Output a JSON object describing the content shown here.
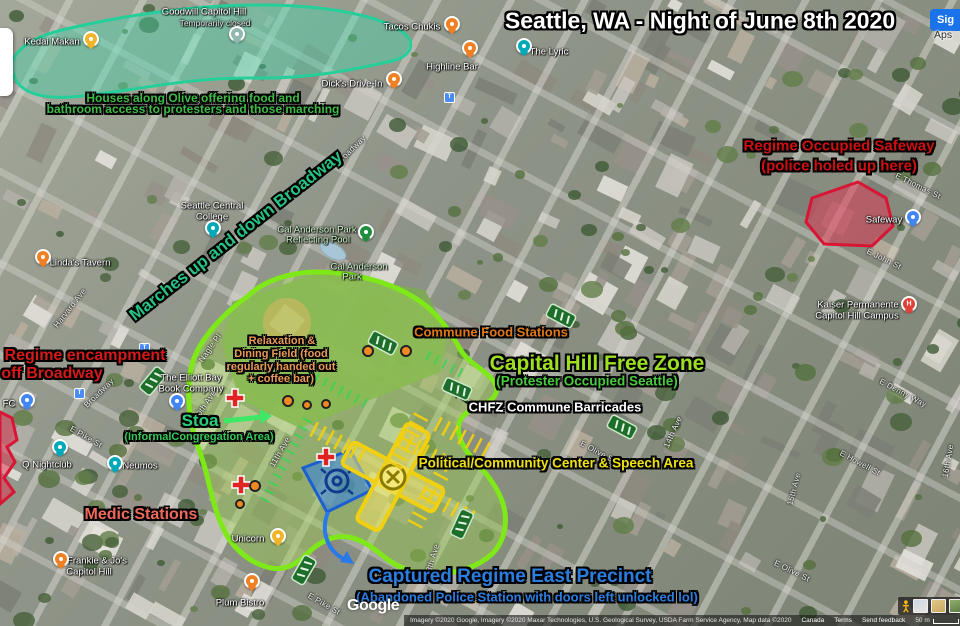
{
  "title": "Seattle, WA - Night of June 8th 2020",
  "colors": {
    "freezone": "#7ee818",
    "freezone_fill": "#9ed44e",
    "olive_houses": "#25cf9a",
    "red_zone": "#d81535",
    "red_zone_fill": "#e23050",
    "precinct": "#1b5fd0",
    "precinct_fill": "#2e7fe8",
    "intersection": "#f0d010",
    "barricade": "#1c6e2a",
    "medic_cross": "#e02424",
    "food_blob": "#f08824",
    "pins": {
      "food": "#ef8024",
      "bar": "#00a9b7",
      "shop": "#4285f4",
      "gold": "#f0b429",
      "park": "#1e8e3e",
      "hospital": "#e04238",
      "muted": "#90b8b0"
    }
  },
  "annotations": [
    {
      "name": "main-title",
      "text": "Seattle, WA - Night of June 8th 2020",
      "x": 700,
      "y": 21,
      "size": 23,
      "color": "#ffffff",
      "rot": 0
    },
    {
      "name": "houses-olive-line1",
      "text": "Houses along Olive offering food and",
      "x": 193,
      "y": 98,
      "size": 12,
      "color": "#3dbb45",
      "rot": 0
    },
    {
      "name": "houses-olive-line2",
      "text": "bathroom access to protesters and those marching",
      "x": 193,
      "y": 109,
      "size": 12,
      "color": "#3dbb45",
      "rot": 0
    },
    {
      "name": "marches-broadway",
      "text": "Marches up and down Broadway",
      "x": 236,
      "y": 236,
      "size": 17,
      "color": "#27c285",
      "rot": -38
    },
    {
      "name": "safeway-line1",
      "text": "Regime Occupied Safeway",
      "x": 839,
      "y": 146,
      "size": 15,
      "color": "#d01010",
      "rot": 0
    },
    {
      "name": "safeway-line2",
      "text": "(police holed up here)",
      "x": 839,
      "y": 166,
      "size": 15,
      "color": "#d01010",
      "rot": 0
    },
    {
      "name": "encampment-line1",
      "text": "Regime encampment",
      "x": 85,
      "y": 356,
      "size": 16,
      "color": "#d41a1a",
      "rot": 0
    },
    {
      "name": "encampment-line2",
      "text": "off Broadway",
      "x": 52,
      "y": 374,
      "size": 16,
      "color": "#d41a1a",
      "rot": 0
    },
    {
      "name": "commune-food",
      "text": "Commune Food Stations",
      "x": 491,
      "y": 332,
      "size": 13,
      "color": "#e07818",
      "rot": 0
    },
    {
      "name": "freezone-title",
      "text": "Capital Hill Free Zone",
      "x": 597,
      "y": 364,
      "size": 21,
      "color": "#9ee020",
      "rot": 0
    },
    {
      "name": "freezone-sub",
      "text": "(Protester Occupied Seattle)",
      "x": 587,
      "y": 381,
      "size": 13.5,
      "color": "#48c93e",
      "rot": 0
    },
    {
      "name": "chfz-barricades",
      "text": "CHFZ Commune Barricades",
      "x": 555,
      "y": 407,
      "size": 13,
      "color": "#ffffff",
      "rot": 0
    },
    {
      "name": "political-center",
      "text": "Political/Community Center & Speech Area",
      "x": 556,
      "y": 463,
      "size": 13.5,
      "color": "#f0e212",
      "rot": 0
    },
    {
      "name": "relax-line1",
      "text": "Relaxation &",
      "x": 282,
      "y": 341,
      "size": 11,
      "color": "#e89858",
      "rot": 0
    },
    {
      "name": "relax-line2",
      "text": "Dining Field (food",
      "x": 281,
      "y": 354,
      "size": 11,
      "color": "#e89858",
      "rot": 0
    },
    {
      "name": "relax-line3",
      "text": "regularly handed out",
      "x": 281,
      "y": 367,
      "size": 11,
      "color": "#e89858",
      "rot": 0
    },
    {
      "name": "relax-line4",
      "text": "+ coffee bar)",
      "x": 281,
      "y": 379,
      "size": 11,
      "color": "#e89858",
      "rot": 0
    },
    {
      "name": "stoa",
      "text": "Stoa",
      "x": 200,
      "y": 421,
      "size": 17,
      "color": "#2ad17c",
      "rot": 0
    },
    {
      "name": "stoa-sub",
      "text": "(InformalCongregation Area)",
      "x": 199,
      "y": 437,
      "size": 11,
      "color": "#35c95a",
      "rot": 0
    },
    {
      "name": "medic-stations",
      "text": "Medic Stations",
      "x": 141,
      "y": 515,
      "size": 16,
      "color": "#ef6a5a",
      "rot": 0
    },
    {
      "name": "precinct-line1",
      "text": "Captured Regime East Precinct",
      "x": 510,
      "y": 577,
      "size": 19,
      "color": "#2b7de0",
      "rot": 0
    },
    {
      "name": "precinct-line2",
      "text": "(Abandoned Police Station with doors left unlocked lol)",
      "x": 527,
      "y": 597,
      "size": 13,
      "color": "#2b7de0",
      "rot": 0
    }
  ],
  "map_labels": [
    {
      "text": "Goodwill Capitol Hill",
      "x": 204,
      "y": 12,
      "kind": "place"
    },
    {
      "text": "Temporarily closed",
      "x": 215,
      "y": 23,
      "kind": "sub"
    },
    {
      "text": "Kedai Makan",
      "x": 52,
      "y": 42,
      "kind": "place"
    },
    {
      "text": "Tacos Chukis",
      "x": 412,
      "y": 27,
      "kind": "place"
    },
    {
      "text": "The Lyric",
      "x": 549,
      "y": 52,
      "kind": "place"
    },
    {
      "text": "Highline Bar",
      "x": 452,
      "y": 67,
      "kind": "place"
    },
    {
      "text": "Dick's Drive-In",
      "x": 352,
      "y": 84,
      "kind": "place"
    },
    {
      "text": "Seattle Central",
      "x": 212,
      "y": 206,
      "kind": "place"
    },
    {
      "text": "College",
      "x": 212,
      "y": 217,
      "kind": "place"
    },
    {
      "text": "Cal Anderson Park",
      "x": 317,
      "y": 230,
      "kind": "park"
    },
    {
      "text": "Reflecting Pool",
      "x": 318,
      "y": 240,
      "kind": "park"
    },
    {
      "text": "Cal Anderson",
      "x": 359,
      "y": 267,
      "kind": "park"
    },
    {
      "text": "Park",
      "x": 352,
      "y": 277,
      "kind": "park"
    },
    {
      "text": "Linda's Tavern",
      "x": 80,
      "y": 263,
      "kind": "place"
    },
    {
      "text": "The Elliott Bay",
      "x": 191,
      "y": 378,
      "kind": "place"
    },
    {
      "text": "Book Company",
      "x": 191,
      "y": 389,
      "kind": "place"
    },
    {
      "text": "Q Nightclub",
      "x": 47,
      "y": 465,
      "kind": "place"
    },
    {
      "text": "Neumos",
      "x": 140,
      "y": 466,
      "kind": "place"
    },
    {
      "text": "FC",
      "x": 9,
      "y": 404,
      "kind": "place"
    },
    {
      "text": "Frankie & Jo's",
      "x": 97,
      "y": 561,
      "kind": "place"
    },
    {
      "text": "Capitol Hill",
      "x": 89,
      "y": 572,
      "kind": "place"
    },
    {
      "text": "Plum Bistro",
      "x": 240,
      "y": 603,
      "kind": "place"
    },
    {
      "text": "Unicorn",
      "x": 248,
      "y": 539,
      "kind": "place"
    },
    {
      "text": "Safeway",
      "x": 884,
      "y": 220,
      "kind": "place"
    },
    {
      "text": "Kaiser Permanente",
      "x": 858,
      "y": 305,
      "kind": "place"
    },
    {
      "text": "Capitol Hill Campus",
      "x": 857,
      "y": 316,
      "kind": "place"
    },
    {
      "text": "Broadway",
      "x": 99,
      "y": 393,
      "kind": "street",
      "rot": -44
    },
    {
      "text": "Broadway",
      "x": 351,
      "y": 150,
      "kind": "street",
      "rot": -44
    },
    {
      "text": "Harvard Ave",
      "x": 70,
      "y": 308,
      "kind": "street",
      "rot": -52
    },
    {
      "text": "Nagle Pl",
      "x": 210,
      "y": 348,
      "kind": "street",
      "rot": -55
    },
    {
      "text": "10th Ave",
      "x": 205,
      "y": 405,
      "kind": "street",
      "rot": -55
    },
    {
      "text": "11th Ave",
      "x": 280,
      "y": 452,
      "kind": "street",
      "rot": -60
    },
    {
      "text": "13th Ave",
      "x": 432,
      "y": 560,
      "kind": "street",
      "rot": -73
    },
    {
      "text": "14th Ave",
      "x": 673,
      "y": 432,
      "kind": "street",
      "rot": -66
    },
    {
      "text": "15th Ave",
      "x": 794,
      "y": 489,
      "kind": "street",
      "rot": -75
    },
    {
      "text": "16th Ave",
      "x": 948,
      "y": 461,
      "kind": "street",
      "rot": -80
    },
    {
      "text": "E Pike St",
      "x": 86,
      "y": 437,
      "kind": "street",
      "rot": 30
    },
    {
      "text": "E Pike St",
      "x": 324,
      "y": 604,
      "kind": "street",
      "rot": 30
    },
    {
      "text": "E Olive St",
      "x": 598,
      "y": 452,
      "kind": "street",
      "rot": 28
    },
    {
      "text": "E Olive St",
      "x": 792,
      "y": 571,
      "kind": "street",
      "rot": 26
    },
    {
      "text": "E Howell St",
      "x": 860,
      "y": 463,
      "kind": "street",
      "rot": 28
    },
    {
      "text": "E Denny Way",
      "x": 903,
      "y": 393,
      "kind": "street",
      "rot": 28
    },
    {
      "text": "E John St",
      "x": 884,
      "y": 259,
      "kind": "street",
      "rot": 26
    },
    {
      "text": "E Thomas St",
      "x": 918,
      "y": 186,
      "kind": "street",
      "rot": 26
    }
  ],
  "pins": [
    {
      "name": "goodwill-pin",
      "kind": "muted",
      "x": 235,
      "y": 40
    },
    {
      "name": "kedai-makan-pin",
      "kind": "gold",
      "x": 89,
      "y": 45
    },
    {
      "name": "tacos-chukis-pin",
      "kind": "food",
      "x": 450,
      "y": 30
    },
    {
      "name": "the-lyric-pin",
      "kind": "bar",
      "x": 522,
      "y": 52
    },
    {
      "name": "highline-bar-pin",
      "kind": "food",
      "x": 468,
      "y": 54
    },
    {
      "name": "dicks-drive-in-pin",
      "kind": "food",
      "x": 392,
      "y": 85
    },
    {
      "name": "seattle-central-pin",
      "kind": "bar",
      "x": 211,
      "y": 234
    },
    {
      "name": "cal-anderson-pin",
      "kind": "park",
      "x": 364,
      "y": 238
    },
    {
      "name": "lindas-tavern-pin",
      "kind": "food",
      "x": 41,
      "y": 263
    },
    {
      "name": "elliott-bay-pin",
      "kind": "shop",
      "x": 175,
      "y": 407
    },
    {
      "name": "q-nightclub-pin",
      "kind": "bar",
      "x": 58,
      "y": 453
    },
    {
      "name": "neumos-pin",
      "kind": "bar",
      "x": 113,
      "y": 469
    },
    {
      "name": "kfc-pin",
      "kind": "shop",
      "x": 25,
      "y": 406
    },
    {
      "name": "frankie-jos-pin",
      "kind": "food",
      "x": 59,
      "y": 565
    },
    {
      "name": "plum-bistro-pin",
      "kind": "food",
      "x": 250,
      "y": 587
    },
    {
      "name": "unicorn-pin",
      "kind": "gold",
      "x": 276,
      "y": 542
    },
    {
      "name": "safeway-pin",
      "kind": "shop",
      "x": 911,
      "y": 223
    },
    {
      "name": "kaiser-pin",
      "kind": "hospital",
      "x": 907,
      "y": 310
    }
  ],
  "transit_icons": [
    {
      "x": 448,
      "y": 96
    },
    {
      "x": 143,
      "y": 347
    },
    {
      "x": 78,
      "y": 392
    }
  ],
  "ui": {
    "sign_in": "Sig",
    "apps": "Aps",
    "google_logo": "Google",
    "attribution": "Imagery ©2020 Google, Imagery ©2020 Maxar Technologies, U.S. Geological Survey, USDA Farm Service Agency, Map data ©2020",
    "links": [
      "Canada",
      "Terms",
      "Send feedback"
    ],
    "scale": "50 m"
  }
}
